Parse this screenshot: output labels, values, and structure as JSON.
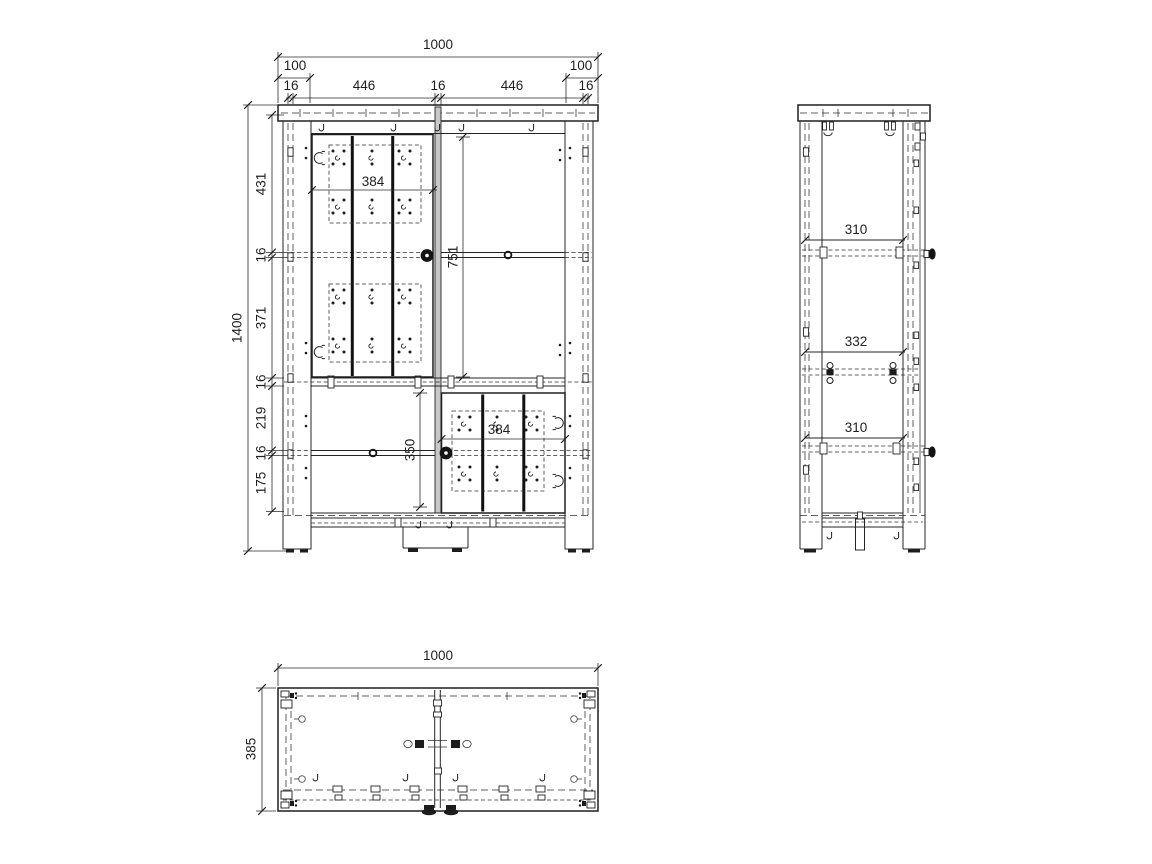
{
  "front_view": {
    "horizontal": {
      "total": "1000",
      "left_leg": "100",
      "right_leg": "100",
      "panel_left": "16",
      "opening_left": "446",
      "panel_center": "16",
      "opening_right": "446",
      "panel_right": "16"
    },
    "vertical": {
      "total": "1400",
      "sec_top": "431",
      "shelf_a": "16",
      "sec_upper_mid": "371",
      "shelf_b": "16",
      "sec_lower_mid": "219",
      "shelf_c": "16",
      "sec_bottom": "175"
    },
    "internal": {
      "upper_door_width": "384",
      "upper_opening_height": "751",
      "lower_opening_height": "350",
      "lower_door_width": "384"
    }
  },
  "side_view": {
    "spacing_top": "310",
    "spacing_middle": "332",
    "spacing_bottom": "310"
  },
  "top_view": {
    "width": "1000",
    "depth": "385"
  }
}
